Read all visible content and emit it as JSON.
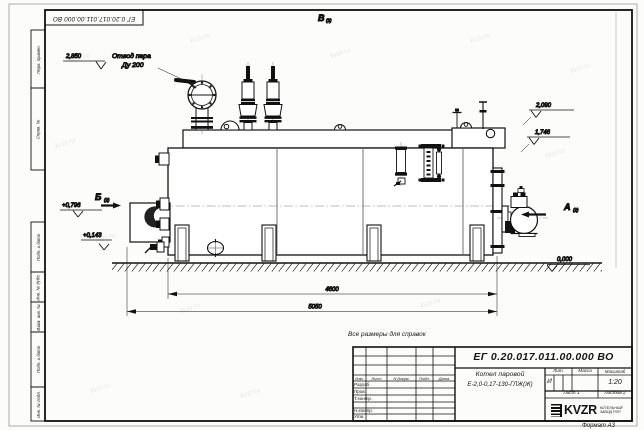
{
  "margins": {
    "top_doc": "ЕГ 0.20.017.011.00.000  ВО",
    "left": [
      "Перв. примен.",
      "Справ. №",
      "Подп. и дата",
      "Инв. № дубл.",
      "Взам. инв. №",
      "Подп. и дата",
      "Инв. № подл."
    ]
  },
  "title_block": {
    "doc_number": "ЕГ 0.20.017.011.00.000  ВО",
    "note": "Все размеры для справок",
    "product": {
      "line1": "Котел паровой",
      "line2": "Е-2,0-0,17-130-ГЛЖ(Ж)"
    },
    "cols": [
      "Изм.",
      "Лист",
      "N докум.",
      "Подп.",
      "Дата"
    ],
    "rows": [
      "Разраб.",
      "Пров.",
      "Т.контр.",
      "Н.контр.",
      "Утв."
    ],
    "lit": {
      "header": "Лит.",
      "value": "И"
    },
    "mass": {
      "header": "Масса",
      "value": ""
    },
    "scale": {
      "header": "Масштаб",
      "value": "1:20"
    },
    "sheet": "Лист 1",
    "sheets": "Листов 2",
    "logo": "KVZR",
    "company": {
      "line1": "КОТЕЛЬНЫЙ",
      "line2": "ЗАВОД РЭП"
    },
    "format": "Формат А3"
  },
  "drawing": {
    "callouts": {
      "steam1": "Отвод пара",
      "steam2": "Ду 200"
    },
    "elevations": {
      "e2850": "2,850",
      "e2090": "2,090",
      "e1746": "1,746",
      "e0796": "+0,796",
      "e0143": "+0,143",
      "e0000": "0,000"
    },
    "dims": {
      "length_body": "4600",
      "length_total": "5050"
    },
    "views": {
      "v": "В",
      "b": "Б",
      "a": "А",
      "ref": "(2)"
    }
  },
  "watermark": {
    "text": "kvzr.ru"
  }
}
